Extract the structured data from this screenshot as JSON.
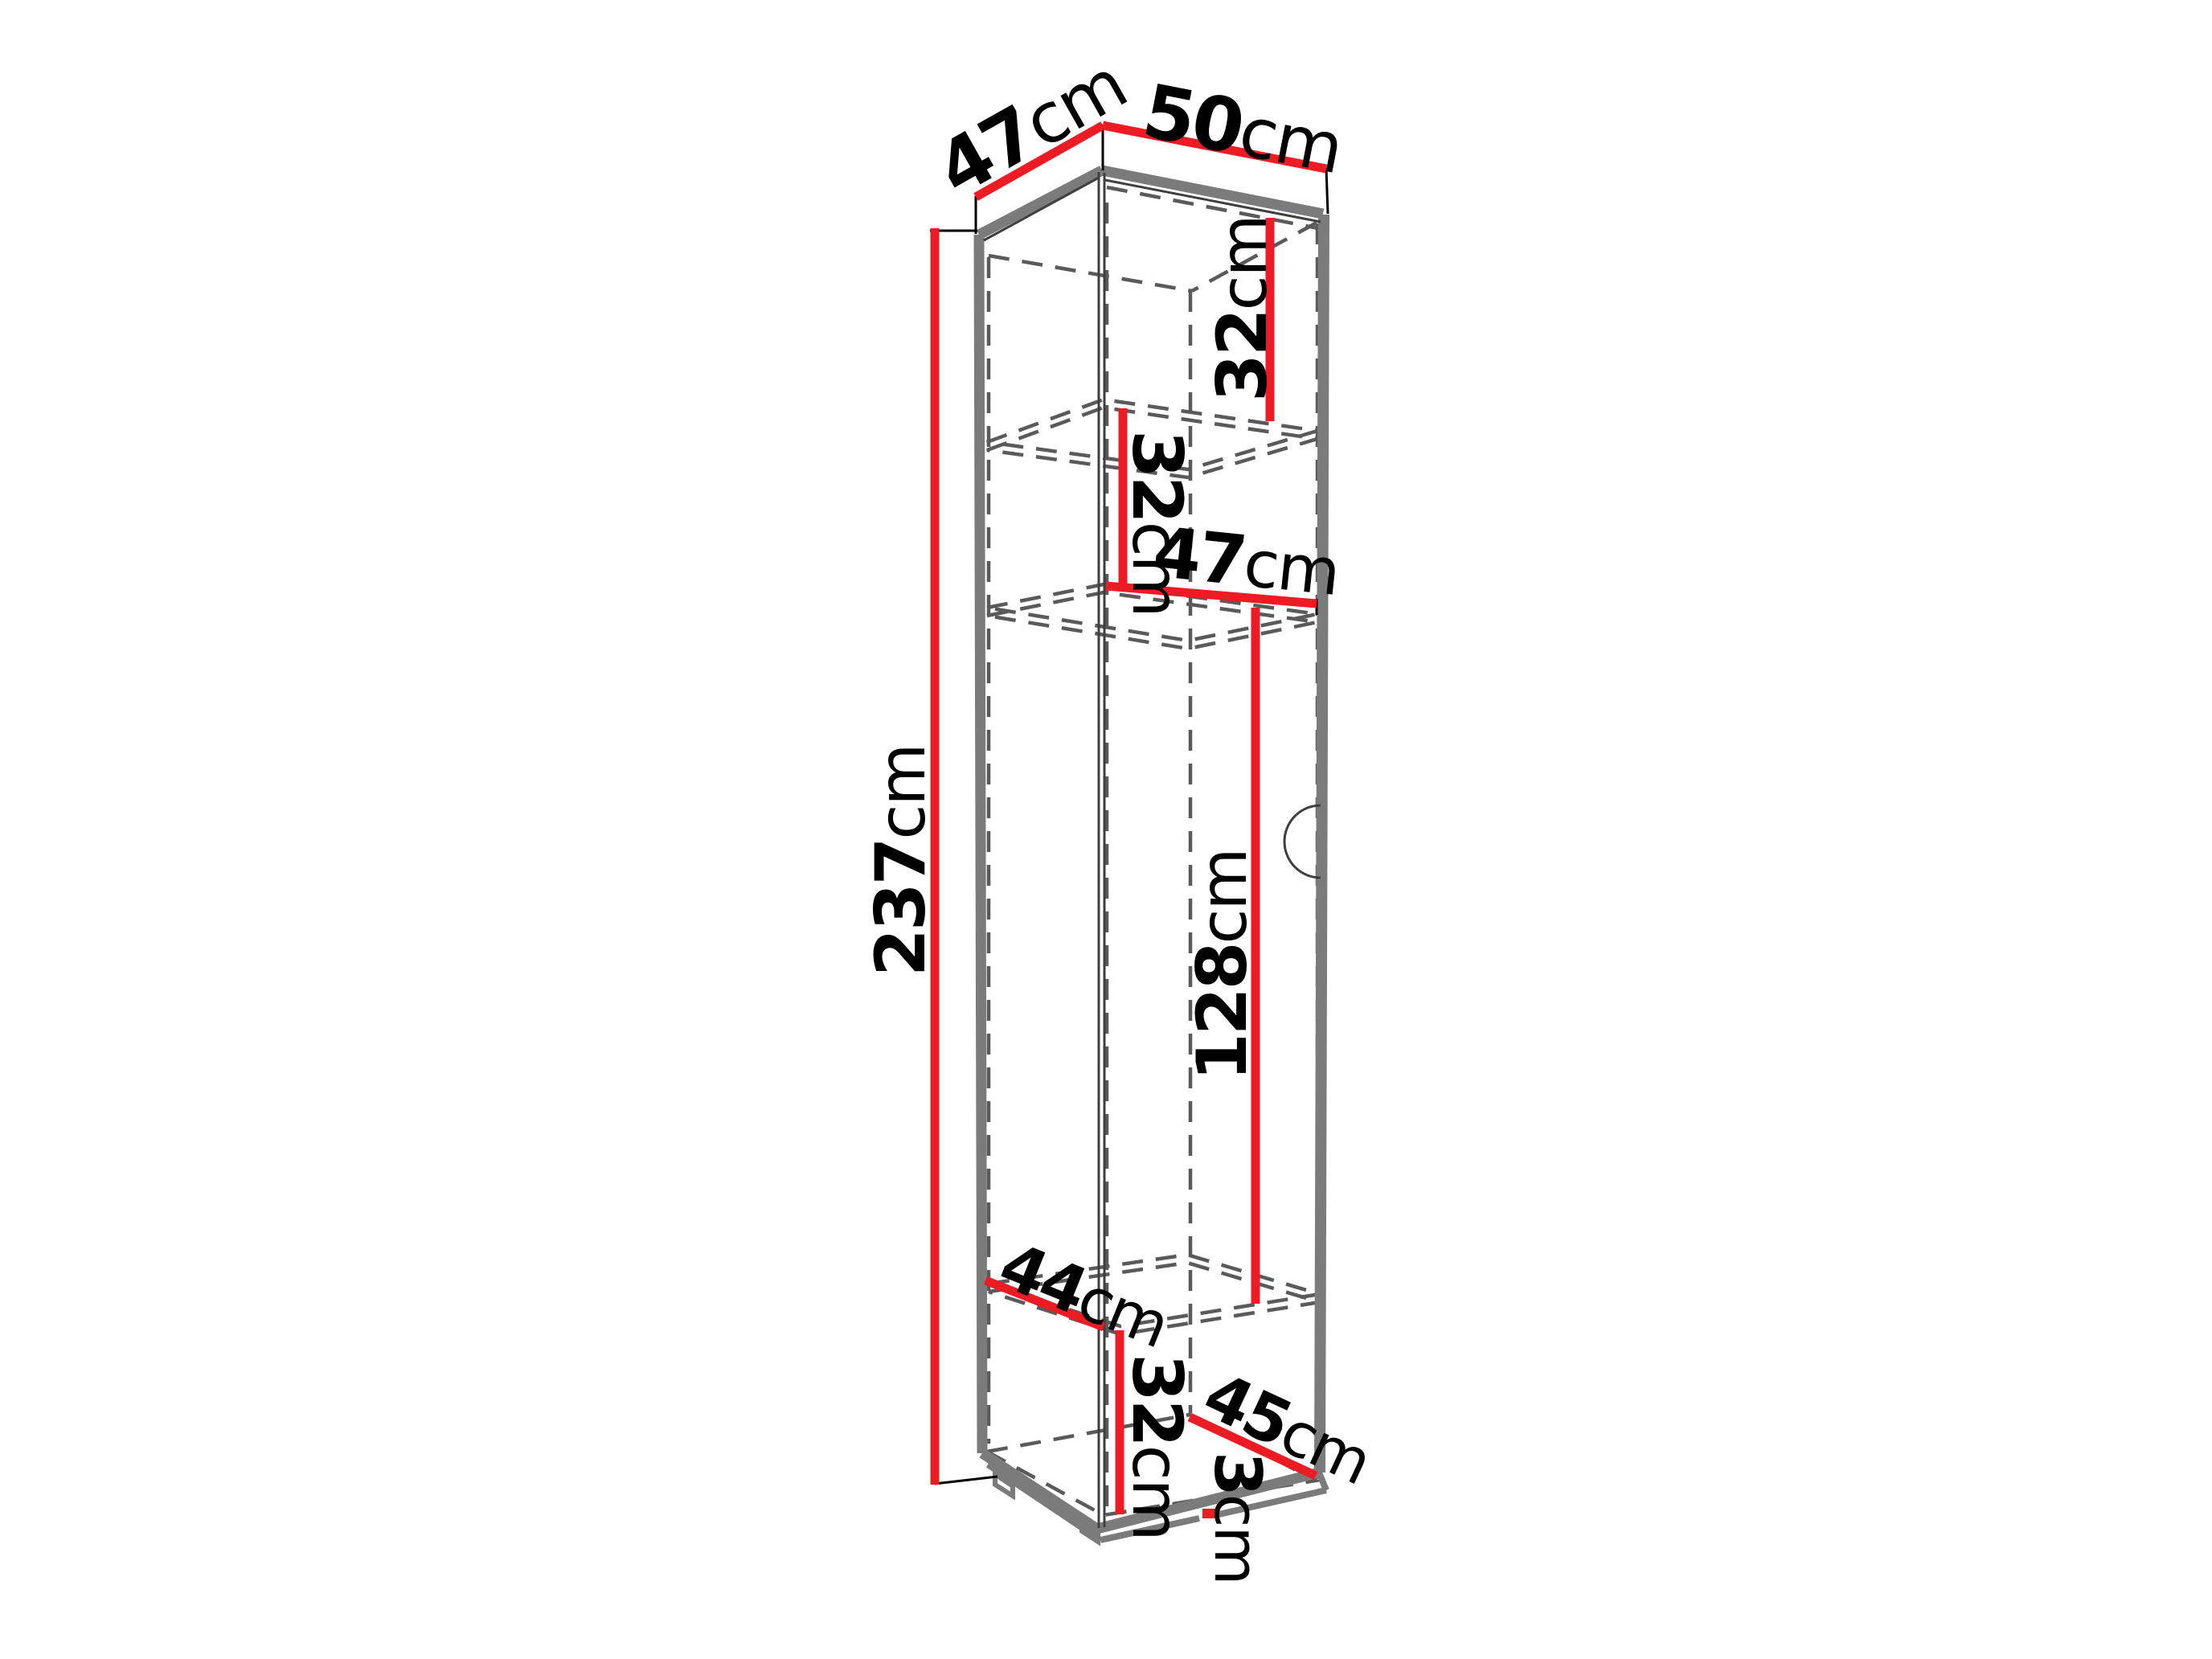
{
  "diagram": {
    "type": "furniture-dimension-diagram",
    "subject": "tall single-door cabinet line drawing with red dimension lines",
    "unit": "cm",
    "colors": {
      "dimension_line": "#ed1c24",
      "outline": "#7b7b7b",
      "hidden_line": "#5a5a5a",
      "label_text": "#000000",
      "background": "#ffffff"
    },
    "dims": {
      "top_depth": {
        "num": "47",
        "unit": "cm"
      },
      "top_width": {
        "num": "50",
        "unit": "cm"
      },
      "upper_shelf": {
        "num": "32",
        "unit": "cm"
      },
      "middle_shelf": {
        "num": "32",
        "unit": "cm"
      },
      "inner_width": {
        "num": "47",
        "unit": "cm"
      },
      "height": {
        "num": "237",
        "unit": "cm"
      },
      "middle_section": {
        "num": "128",
        "unit": "cm"
      },
      "bottom_depth": {
        "num": "44",
        "unit": "cm"
      },
      "bottom_shelf": {
        "num": "32",
        "unit": "cm"
      },
      "bottom_inner_depth": {
        "num": "45",
        "unit": "cm"
      },
      "plinth_height": {
        "num": "3",
        "unit": "cm"
      }
    }
  }
}
